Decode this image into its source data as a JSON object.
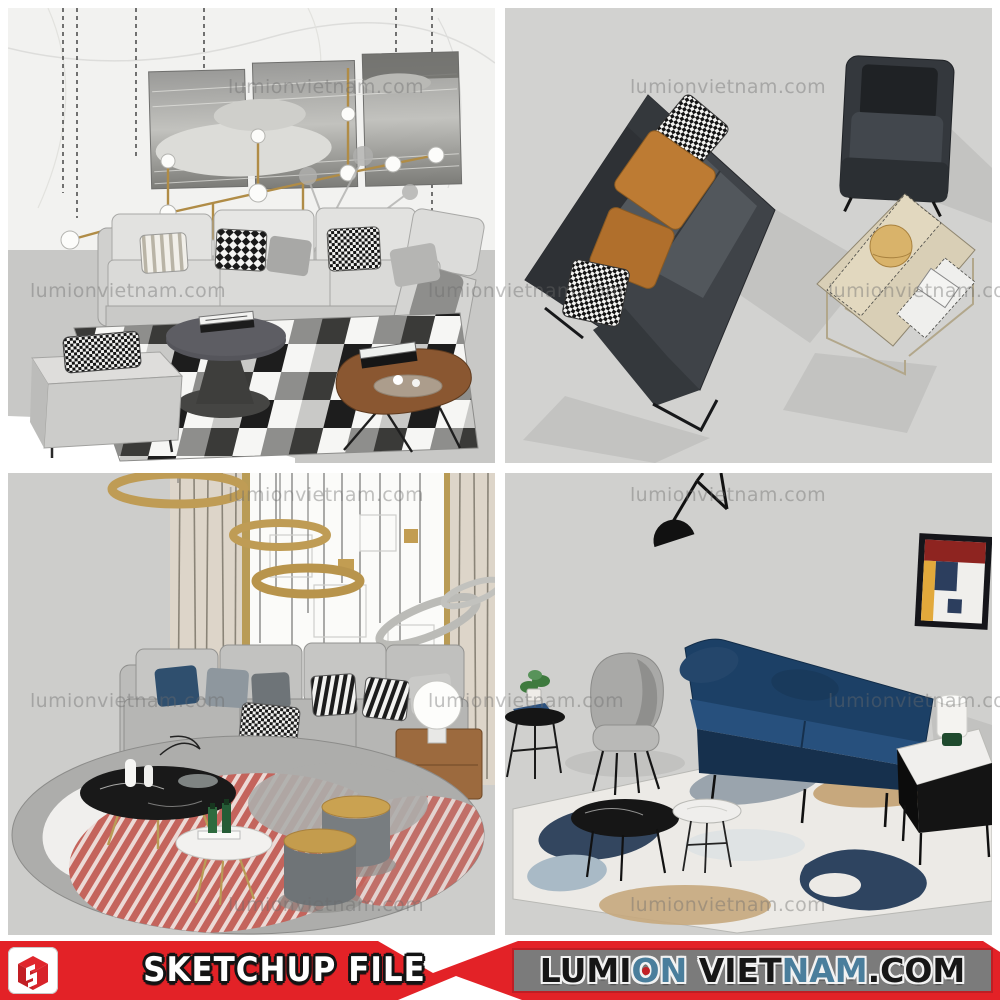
{
  "page": {
    "background": "#ffffff",
    "tile_background": "#d2d2d0",
    "grid": "2x2 render tiles above a promo banner"
  },
  "watermark": {
    "text": "lumionvietnam.com",
    "color": "rgba(108,108,108,0.42)"
  },
  "banner": {
    "left": {
      "background": "#e32227",
      "logo_icon": "sketchup-cube-logo",
      "title": "SKETCHUP FILE",
      "title_color": "#ffffff",
      "title_outline": "#141414"
    },
    "right": {
      "background": "#7b7b7b",
      "border_color": "#bf1e24",
      "segments": [
        {
          "text": "LUMI",
          "color": "#161616"
        },
        {
          "text": "O",
          "color": "#4a7e9c"
        },
        {
          "text": "N",
          "color": "#4a7e9c"
        },
        {
          "text": " VIET",
          "color": "#161616"
        },
        {
          "text": "NAM",
          "color": "#4a7e9c"
        },
        {
          "text": ".COM",
          "color": "#161616"
        }
      ]
    }
  },
  "scenes": [
    {
      "id": "top-left",
      "name": "white-sectional-living-set",
      "palette": {
        "wall": "#f2f2f0",
        "floor": "#c8c8c6",
        "sofa": "#e4e4e2",
        "wood": "#8a5731",
        "gold": "#b08c46",
        "rug": [
          "#f6f6f4",
          "#1d1d1d",
          "#8e8e8c"
        ]
      }
    },
    {
      "id": "top-right",
      "name": "charcoal-sofa-armchair-set",
      "palette": {
        "background": "#d2d2d0",
        "sofa": "#3f4348",
        "pillow_orange": "#bd7b33",
        "table_wood": "#d9cfb6"
      }
    },
    {
      "id": "bottom-left",
      "name": "gray-sofa-round-rug-set",
      "palette": {
        "wall": "#fbfbf9",
        "curtain": "#ddd5c9",
        "gold": "#bf9c55",
        "sofa": "#b6b6b4",
        "rug_red": "#c4645c",
        "marble": "#191919"
      }
    },
    {
      "id": "bottom-right",
      "name": "navy-sofa-abstract-rug-set",
      "palette": {
        "background": "#d0d0ce",
        "sofa": "#1c4066",
        "rug": "#eceae6",
        "art": [
          "#8e2420",
          "#e2a93b",
          "#2c3e5e",
          "#f0efec"
        ]
      }
    }
  ]
}
